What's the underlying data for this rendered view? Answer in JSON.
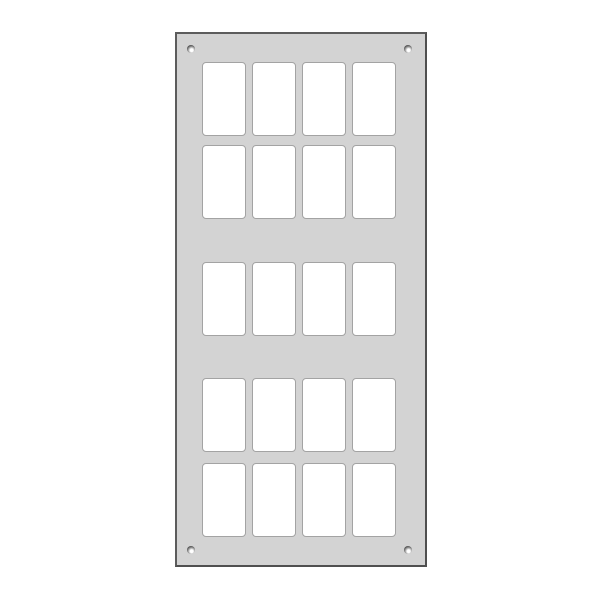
{
  "panel": {
    "description": "Blank light-gray switch panel faceplate with rectangular cutouts, shown on a white background",
    "grid": {
      "rows": 5,
      "columns": 4,
      "total_cutouts": 20,
      "row_groups": [
        2,
        1,
        2
      ],
      "cutout_shape": "rounded-rectangle"
    },
    "screws": {
      "count": 4,
      "positions": [
        "top-left",
        "top-right",
        "bottom-left",
        "bottom-right"
      ]
    },
    "colors": {
      "background": "#ffffff",
      "plate_fill": "#d3d3d3",
      "plate_border": "#5c5c5c",
      "cutout_fill": "#ffffff",
      "cutout_border": "#a3a3a3"
    }
  }
}
